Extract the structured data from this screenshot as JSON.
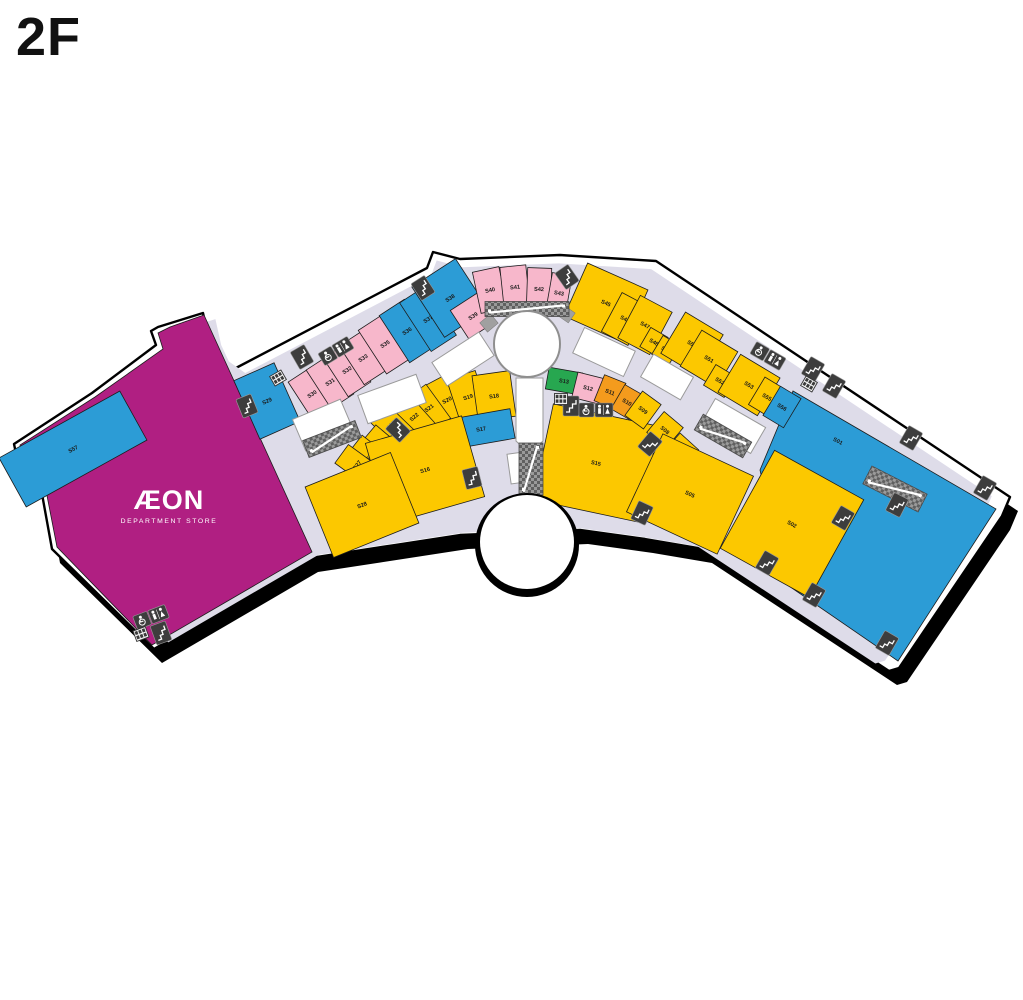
{
  "title": "2F",
  "aeon": {
    "brand": "ÆON",
    "sub": "DEPARTMENT STORE"
  },
  "colors": {
    "yellow": "#FCC800",
    "blue": "#2C9CD6",
    "pink": "#F7B7CB",
    "magenta": "#B01F82",
    "orange": "#F49B1D",
    "green": "#27A750",
    "white_unit": "#FFFFFF",
    "corridor": "#DEDCE9",
    "body": "#FFFFFF",
    "outline": "#000000",
    "hatch_light": "#9A9A9A",
    "hatch_dark": "#606060",
    "icon_dark": "#3D3D3D",
    "label": "#1A1A1A",
    "atrium_stroke": "#8F8F8F",
    "vacant_stroke": "#9A9A9A",
    "service_gray": "#A0A0A0"
  },
  "building": {
    "outline": "M158,327 L203,313 L209,340 L217,357 L234,369 L427,268 L433,252 L460,259 L560,255 L656,261 L1010,497 L1002,516 L899,668 L889,671 L704,549 L645,539 L580,530 L460,535 L395,545 L310,558 L154,649 L52,549 L38,472 L17,458 L14,444 L92,393 L156,345 L151,331 Z",
    "shadow_dx": 8,
    "shadow_dy": 14,
    "corridor_scale": 0.962,
    "corridor_cx": 530,
    "corridor_cy": 475
  },
  "atrium": {
    "cx": 527,
    "cy": 344,
    "r": 33
  },
  "notch": {
    "cx": 527,
    "cy": 542,
    "r": 47,
    "ring": 5
  },
  "stores": [
    {
      "id": "AEON",
      "color": "magenta",
      "points": "204,315 312,552 152,645 57,547 42,470 23,458 20,445 95,397 163,349 158,333 170,327"
    },
    {
      "id": "S01",
      "color": "blue",
      "points": "793,391 996,509 898,661 786,584 760,470",
      "lx": 838,
      "ly": 441,
      "lrot": 28
    },
    {
      "id": "S57",
      "color": "blue",
      "cx": 73,
      "cy": 449,
      "w": 138,
      "h": 56,
      "rot": -29
    },
    {
      "id": "S29",
      "color": "blue",
      "cx": 267,
      "cy": 401,
      "w": 44,
      "h": 64,
      "rot": -24
    },
    {
      "id": "S30",
      "color": "pink",
      "cx": 312,
      "cy": 394,
      "w": 27,
      "h": 46,
      "rot": -33
    },
    {
      "id": "S31",
      "color": "pink",
      "cx": 330,
      "cy": 382,
      "w": 27,
      "h": 46,
      "rot": -33
    },
    {
      "id": "S32",
      "color": "pink",
      "cx": 347,
      "cy": 370,
      "w": 27,
      "h": 46,
      "rot": -33
    },
    {
      "id": "S33",
      "color": "pink",
      "cx": 363,
      "cy": 358,
      "w": 27,
      "h": 46,
      "rot": -33
    },
    {
      "id": "S35",
      "color": "pink",
      "cx": 385,
      "cy": 344,
      "w": 30,
      "h": 52,
      "rot": -33
    },
    {
      "id": "S36",
      "color": "blue",
      "cx": 407,
      "cy": 331,
      "w": 30,
      "h": 56,
      "rot": -33
    },
    {
      "id": "S37",
      "color": "blue",
      "cx": 428,
      "cy": 319,
      "w": 30,
      "h": 58,
      "rot": -33
    },
    {
      "id": "S38",
      "color": "blue",
      "cx": 450,
      "cy": 298,
      "w": 52,
      "h": 60,
      "rot": -33
    },
    {
      "id": "S39",
      "color": "pink",
      "cx": 473,
      "cy": 316,
      "w": 32,
      "h": 34,
      "rot": -33
    },
    {
      "id": "S40",
      "color": "pink",
      "cx": 490,
      "cy": 290,
      "w": 27,
      "h": 42,
      "rot": -12
    },
    {
      "id": "S41",
      "color": "pink",
      "cx": 515,
      "cy": 287,
      "w": 26,
      "h": 42,
      "rot": -6
    },
    {
      "id": "S42",
      "color": "pink",
      "cx": 539,
      "cy": 289,
      "w": 24,
      "h": 42,
      "rot": 2
    },
    {
      "id": "S43",
      "color": "pink",
      "cx": 559,
      "cy": 293,
      "w": 20,
      "h": 38,
      "rot": 10
    },
    {
      "id": "S45",
      "color": "yellow",
      "cx": 606,
      "cy": 303,
      "w": 66,
      "h": 58,
      "rot": 24
    },
    {
      "id": "S46",
      "color": "yellow",
      "cx": 625,
      "cy": 319,
      "w": 30,
      "h": 44,
      "rot": 28
    },
    {
      "id": "S47",
      "color": "yellow",
      "cx": 645,
      "cy": 325,
      "w": 36,
      "h": 48,
      "rot": 28
    },
    {
      "id": "S48",
      "color": "yellow",
      "cx": 654,
      "cy": 342,
      "w": 20,
      "h": 22,
      "rot": 30
    },
    {
      "id": "S49",
      "color": "yellow",
      "cx": 666,
      "cy": 350,
      "w": 20,
      "h": 22,
      "rot": 31
    },
    {
      "id": "S50",
      "color": "yellow",
      "cx": 692,
      "cy": 344,
      "w": 44,
      "h": 48,
      "rot": 31
    },
    {
      "id": "S51",
      "color": "yellow",
      "cx": 709,
      "cy": 359,
      "w": 42,
      "h": 42,
      "rot": 31
    },
    {
      "id": "S52",
      "color": "yellow",
      "cx": 720,
      "cy": 381,
      "w": 24,
      "h": 24,
      "rot": 31
    },
    {
      "id": "S53",
      "color": "yellow",
      "cx": 749,
      "cy": 385,
      "w": 46,
      "h": 44,
      "rot": 31
    },
    {
      "id": "S55",
      "color": "yellow",
      "cx": 767,
      "cy": 397,
      "w": 24,
      "h": 32,
      "rot": 31
    },
    {
      "id": "S56",
      "color": "blue",
      "cx": 782,
      "cy": 407,
      "w": 24,
      "h": 34,
      "rot": 31
    },
    {
      "id": "S20",
      "color": "yellow",
      "cx": 447,
      "cy": 400,
      "w": 28,
      "h": 46,
      "rot": -28
    },
    {
      "id": "S19",
      "color": "yellow",
      "cx": 468,
      "cy": 397,
      "w": 30,
      "h": 46,
      "rot": -18
    },
    {
      "id": "S18",
      "color": "yellow",
      "cx": 494,
      "cy": 396,
      "w": 38,
      "h": 46,
      "rot": -8
    },
    {
      "id": "S17",
      "color": "blue",
      "cx": 481,
      "cy": 429,
      "w": 64,
      "h": 30,
      "rot": -10
    },
    {
      "id": "S21",
      "color": "yellow",
      "cx": 429,
      "cy": 408,
      "w": 23,
      "h": 42,
      "rot": -36
    },
    {
      "id": "S22",
      "color": "yellow",
      "cx": 414,
      "cy": 417,
      "w": 23,
      "h": 40,
      "rot": -42
    },
    {
      "id": "S23",
      "color": "yellow",
      "cx": 391,
      "cy": 425,
      "w": 25,
      "h": 42,
      "rot": -46
    },
    {
      "id": "S25",
      "color": "yellow",
      "cx": 383,
      "cy": 446,
      "w": 23,
      "h": 38,
      "rot": -50
    },
    {
      "id": "S26",
      "color": "yellow",
      "cx": 370,
      "cy": 456,
      "w": 23,
      "h": 38,
      "rot": -52
    },
    {
      "id": "S27",
      "color": "yellow",
      "cx": 357,
      "cy": 465,
      "w": 23,
      "h": 38,
      "rot": -54
    },
    {
      "id": "S16",
      "color": "yellow",
      "cx": 425,
      "cy": 470,
      "w": 100,
      "h": 84,
      "rot": -16
    },
    {
      "id": "S28",
      "color": "yellow",
      "cx": 362,
      "cy": 505,
      "w": 92,
      "h": 76,
      "rot": -22
    },
    {
      "id": "S15",
      "color": "yellow",
      "cx": 596,
      "cy": 463,
      "w": 108,
      "h": 98,
      "rot": 12
    },
    {
      "id": "S13",
      "color": "green",
      "cx": 564,
      "cy": 381,
      "w": 34,
      "h": 22,
      "rot": 10
    },
    {
      "id": "S12",
      "color": "pink",
      "cx": 588,
      "cy": 388,
      "w": 27,
      "h": 26,
      "rot": 14
    },
    {
      "id": "S11",
      "color": "orange",
      "cx": 610,
      "cy": 392,
      "w": 23,
      "h": 28,
      "rot": 22
    },
    {
      "id": "S10",
      "color": "orange",
      "cx": 627,
      "cy": 402,
      "w": 21,
      "h": 28,
      "rot": 30
    },
    {
      "id": "S09",
      "color": "yellow",
      "cx": 643,
      "cy": 410,
      "w": 23,
      "h": 30,
      "rot": 36
    },
    {
      "id": "S08",
      "color": "yellow",
      "cx": 665,
      "cy": 430,
      "w": 25,
      "h": 27,
      "rot": 40
    },
    {
      "id": "S07",
      "color": "yellow",
      "cx": 679,
      "cy": 453,
      "w": 25,
      "h": 31,
      "rot": 42
    },
    {
      "id": "S05",
      "color": "yellow",
      "cx": 690,
      "cy": 494,
      "w": 100,
      "h": 86,
      "rot": 25
    },
    {
      "id": "S02",
      "color": "yellow",
      "cx": 792,
      "cy": 524,
      "w": 102,
      "h": 112,
      "rot": 29
    }
  ],
  "vacant_units": [
    {
      "cx": 392,
      "cy": 399,
      "w": 62,
      "h": 30,
      "rot": -20
    },
    {
      "cx": 323,
      "cy": 425,
      "w": 52,
      "h": 34,
      "rot": -23
    },
    {
      "cx": 463,
      "cy": 359,
      "w": 56,
      "h": 28,
      "rot": -33
    },
    {
      "cx": 604,
      "cy": 352,
      "w": 56,
      "h": 28,
      "rot": 25
    },
    {
      "cx": 667,
      "cy": 377,
      "w": 46,
      "h": 26,
      "rot": 30
    },
    {
      "cx": 733,
      "cy": 426,
      "w": 58,
      "h": 30,
      "rot": 30
    },
    {
      "points": "516,378 543,378 543,441 529,453 516,441"
    },
    {
      "cx": 517,
      "cy": 468,
      "w": 16,
      "h": 30,
      "rot": -8
    }
  ],
  "escalators": [
    {
      "cx": 332,
      "cy": 439,
      "w": 56,
      "h": 18,
      "rot": -21
    },
    {
      "cx": 527,
      "cy": 309,
      "w": 84,
      "h": 15,
      "rot": 0
    },
    {
      "cx": 531,
      "cy": 469,
      "w": 24,
      "h": 52,
      "rot": 0
    },
    {
      "cx": 723,
      "cy": 436,
      "w": 56,
      "h": 18,
      "rot": 30
    },
    {
      "cx": 895,
      "cy": 489,
      "w": 62,
      "h": 20,
      "rot": 27
    }
  ],
  "service_blocks": [
    {
      "cx": 489,
      "cy": 323,
      "w": 14,
      "h": 12,
      "rot": -40
    },
    {
      "cx": 566,
      "cy": 314,
      "w": 14,
      "h": 12,
      "rot": 35
    }
  ],
  "icons": [
    {
      "type": "stairs",
      "x": 247,
      "y": 406,
      "rot": -22
    },
    {
      "type": "stairs",
      "x": 302,
      "y": 357,
      "rot": -30
    },
    {
      "type": "stairs",
      "x": 423,
      "y": 288,
      "rot": -33
    },
    {
      "type": "stairs",
      "x": 567,
      "y": 277,
      "rot": -35
    },
    {
      "type": "stairs",
      "x": 398,
      "y": 430,
      "rot": -46
    },
    {
      "type": "stairs",
      "x": 472,
      "y": 478,
      "rot": -14
    },
    {
      "type": "stairs",
      "x": 650,
      "y": 444,
      "rot": 40
    },
    {
      "type": "stairs",
      "x": 571,
      "y": 406,
      "rot": 0
    },
    {
      "type": "stairs",
      "x": 642,
      "y": 513,
      "rot": 25
    },
    {
      "type": "stairs",
      "x": 834,
      "y": 386,
      "rot": 30
    },
    {
      "type": "stairs",
      "x": 813,
      "y": 369,
      "rot": 30
    },
    {
      "type": "stairs",
      "x": 911,
      "y": 438,
      "rot": 30
    },
    {
      "type": "stairs",
      "x": 985,
      "y": 488,
      "rot": 30
    },
    {
      "type": "stairs",
      "x": 843,
      "y": 518,
      "rot": 30
    },
    {
      "type": "stairs",
      "x": 767,
      "y": 563,
      "rot": 30
    },
    {
      "type": "stairs",
      "x": 814,
      "y": 595,
      "rot": 30
    },
    {
      "type": "stairs",
      "x": 887,
      "y": 643,
      "rot": 30
    },
    {
      "type": "stairs",
      "x": 897,
      "y": 505,
      "rot": 27
    },
    {
      "type": "stairs",
      "x": 161,
      "y": 633,
      "rot": -20
    },
    {
      "type": "restroom",
      "x": 336,
      "y": 351,
      "rot": -31
    },
    {
      "type": "restroom",
      "x": 596,
      "y": 410,
      "rot": 0
    },
    {
      "type": "restroom",
      "x": 768,
      "y": 356,
      "rot": 30
    },
    {
      "type": "restroom",
      "x": 151,
      "y": 617,
      "rot": -21
    },
    {
      "type": "locker",
      "x": 278,
      "y": 378,
      "rot": -30
    },
    {
      "type": "locker",
      "x": 561,
      "y": 399,
      "rot": 0
    },
    {
      "type": "locker",
      "x": 809,
      "y": 384,
      "rot": 30
    },
    {
      "type": "locker",
      "x": 141,
      "y": 634,
      "rot": -20
    }
  ]
}
